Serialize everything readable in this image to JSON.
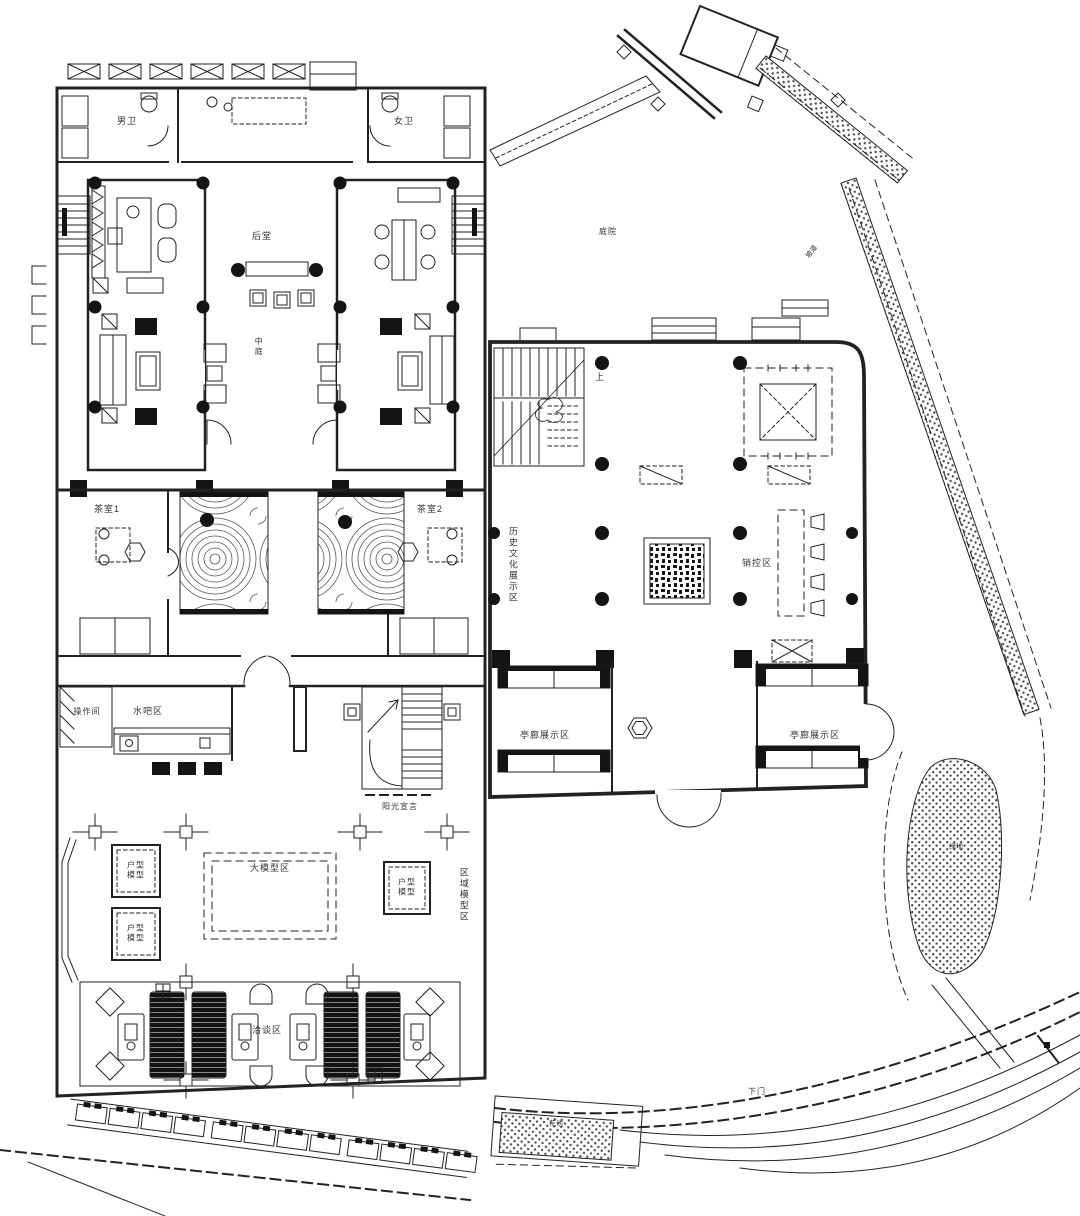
{
  "colors": {
    "line": "#222222",
    "background": "#ffffff"
  },
  "labels": {
    "mens_wc": "男卫",
    "womens_wc": "女卫",
    "rear_hall": "后堂",
    "atrium": "中庭",
    "tea_room_1": "茶室1",
    "tea_room_2": "茶室2",
    "history_zone": "历史文化展示区",
    "sales_control": "销控区",
    "pavilion_left": "亭廊展示区",
    "pavilion_right": "亭廊展示区",
    "operation_room": "操作间",
    "water_bar": "水吧区",
    "sunshine": "阳光宣言",
    "unit_model_1": "户型\n模型",
    "unit_model_2": "户型\n模型",
    "unit_model_3": "户型\n模型",
    "large_model": "大模型区",
    "region_model": "区域模型区",
    "negotiation": "洽谈区",
    "stair_up": "上",
    "site_yard": "庭院",
    "ramp": "坡道",
    "green_bed": "绿地",
    "flower_strip": "花池",
    "gate": "下门"
  }
}
